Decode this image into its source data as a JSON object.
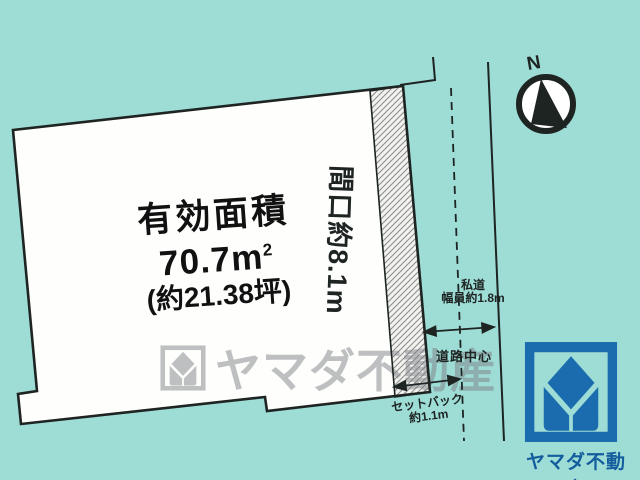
{
  "colors": {
    "bg": "#9edcd6",
    "ink": "#1d2422",
    "hatch-line": "#8e8e8e",
    "hatch-bg": "#f2f2ef",
    "parcel-fill": "#fefefc",
    "logo-blue": "#1a6cae",
    "brand-blue": "#135d9d",
    "watermark": "rgba(125,128,134,0.5)"
  },
  "parcel": {
    "area_title": "有効面積",
    "area_value": "70.7m",
    "area_value_sup": "2",
    "area_tsubo": "(約21.38坪)",
    "frontage": "間口約8.1m"
  },
  "road": {
    "type_label": "私道",
    "width_label": "幅員約1.8m",
    "center_label": "道路中心",
    "setback_label": "セットバック",
    "setback_value": "約1.1m"
  },
  "compass": {
    "north": "N"
  },
  "watermark": {
    "company": "ヤマダ不動産"
  },
  "branding": {
    "company": "ヤマダ不動産"
  }
}
